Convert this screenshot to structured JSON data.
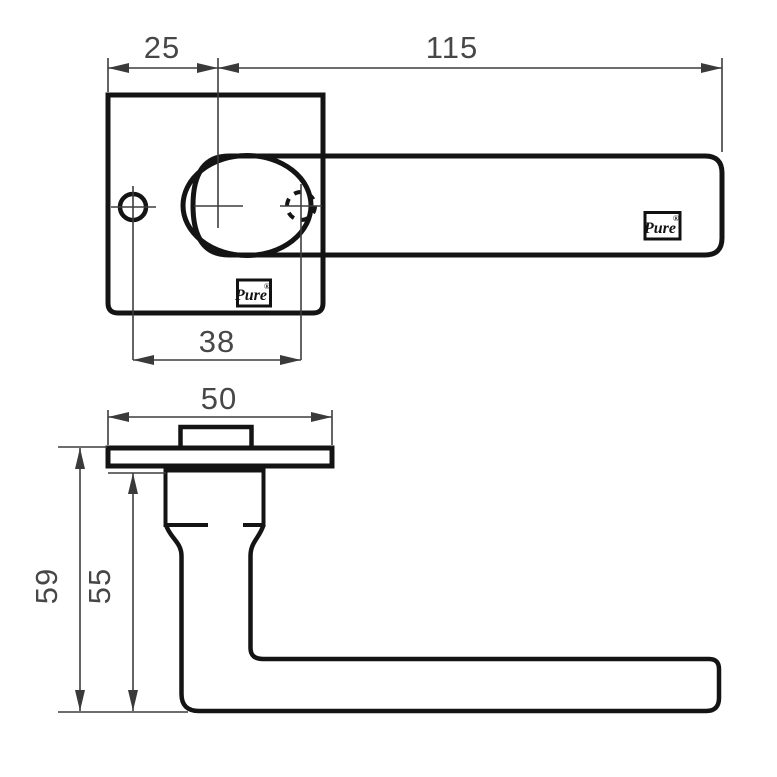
{
  "drawing": {
    "colors": {
      "line": "#141414",
      "dim": "#3d3d3d",
      "background": "#ffffff"
    },
    "top_view": {
      "dim_plate_offset": "25",
      "dim_lever_length": "115",
      "dim_hole_to_spindle": "38",
      "plate_logo": {
        "text": "Pure",
        "mark": "®"
      },
      "lever_logo": {
        "text": "Pure",
        "mark": "®"
      }
    },
    "side_view": {
      "dim_rose_width": "50",
      "dim_overall_height": "59",
      "dim_under_rose_height": "55"
    }
  }
}
